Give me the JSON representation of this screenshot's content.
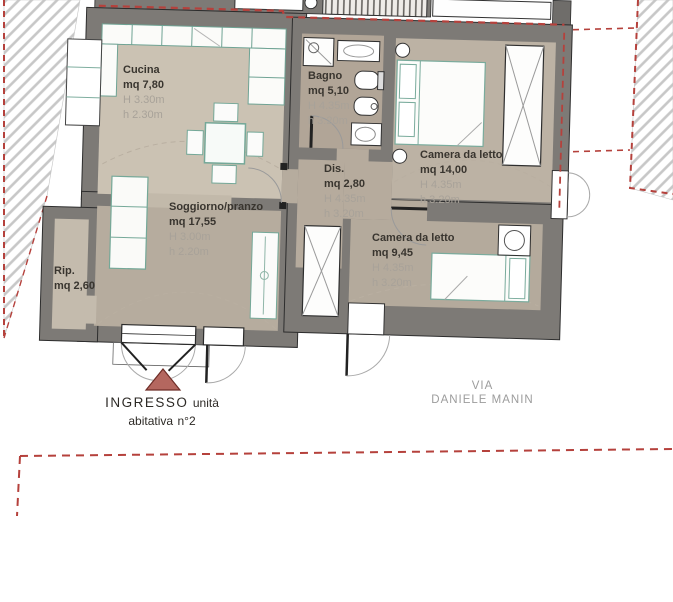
{
  "rooms": [
    {
      "name": "Cucina",
      "area": "mq 7,80",
      "H": "H 3.30m",
      "h": "h 2.30m"
    },
    {
      "name": "Bagno",
      "area": "mq 5,10",
      "H": "H 4.35m",
      "h": "h 3.20m"
    },
    {
      "name": "Camera da letto",
      "area": "mq 14,00",
      "H": "H 4.35m",
      "h": "h 3.20m"
    },
    {
      "name": "Dis.",
      "area": "mq 2,80",
      "H": "H 4.35m",
      "h": "h 3.20m"
    },
    {
      "name": "Soggiorno/pranzo",
      "area": "mq 17,55",
      "H": "H 3.00m",
      "h": "h 2.20m"
    },
    {
      "name": "Rip.",
      "area": "mq 2,60",
      "H": "",
      "h": ""
    },
    {
      "name": "Camera da letto",
      "area": "mq 9,45",
      "H": "H 4.35m",
      "h": "h 3.20m"
    }
  ],
  "entrance": {
    "line1": "INGRESSO",
    "line2": "unità abitativa",
    "line3": "n°2"
  },
  "street": {
    "line1": "VIA",
    "line2": "DANIELE MANIN"
  },
  "colors": {
    "wall": "#7d7a76",
    "boundary_red": "#b5413c",
    "entrance_triangle": "#b4675f",
    "furniture_teal": "#74a898",
    "floor_kitchen": "#cbc2b3",
    "floor_living": "#b6ac9e",
    "floor_bath": "#b1a597",
    "floor_bedroom1": "#bcb2a4",
    "floor_bedroom2": "#b4aa9c"
  }
}
